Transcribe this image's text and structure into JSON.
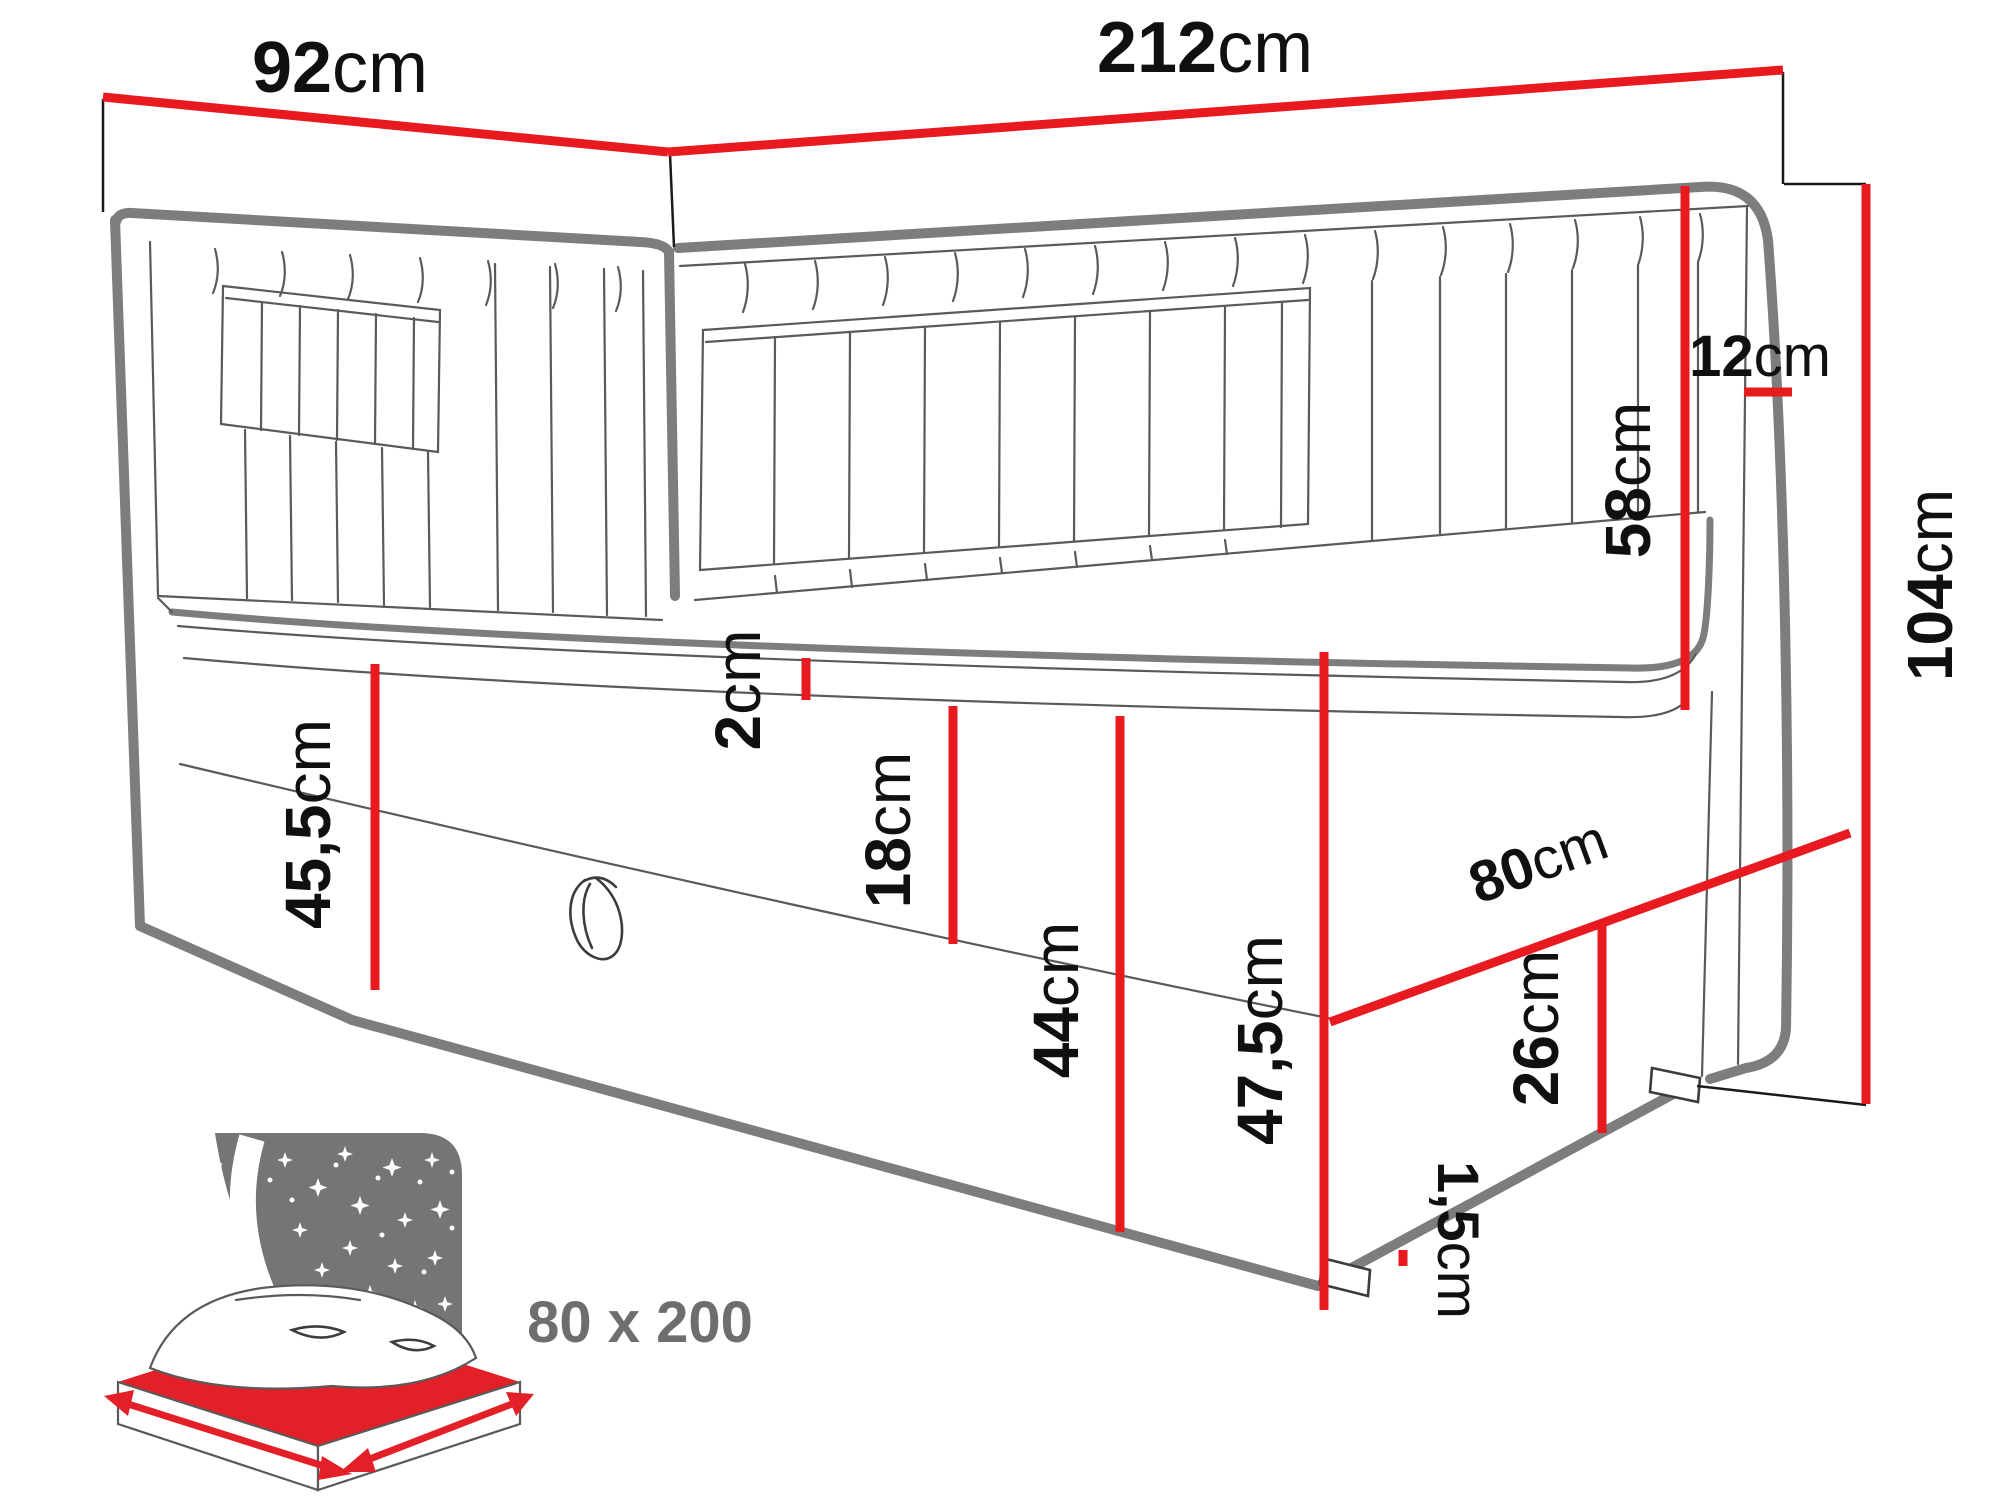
{
  "diagram_title": "Corner daybed dimension drawing",
  "colors": {
    "dimension_red": "#e8191f",
    "drawing_gray": "#7d7d7d",
    "detail_gray": "#5a5a5a",
    "text_black": "#101010",
    "icon_gray": "#757575",
    "icon_red": "#e32028",
    "badge_text_gray": "#6e6e6e"
  },
  "dimensions": {
    "side_width": {
      "num": "92",
      "unit": "cm"
    },
    "back_width": {
      "num": "212",
      "unit": "cm"
    },
    "headboard_thickness": {
      "num": "12",
      "unit": "cm"
    },
    "total_height": {
      "num": "104",
      "unit": "cm"
    },
    "headboard_height": {
      "num": "58",
      "unit": "cm"
    },
    "topper_height": {
      "num": "2",
      "unit": "cm"
    },
    "mattress_height": {
      "num": "18",
      "unit": "cm"
    },
    "base_height": {
      "num": "44",
      "unit": "cm"
    },
    "left_side_height": {
      "num": "45,5",
      "unit": "cm"
    },
    "right_side_height": {
      "num": "47,5",
      "unit": "cm"
    },
    "foot_width": {
      "num": "80",
      "unit": "cm"
    },
    "foot_panel_height": {
      "num": "26",
      "unit": "cm"
    },
    "leg_height": {
      "num": "1,5",
      "unit": "cm"
    }
  },
  "badge": {
    "sleeping_area": "80 x 200"
  },
  "icons": [
    "starry-headboard-icon",
    "crescent-fold-icon",
    "mattress-size-icon",
    "width-arrow-icon",
    "depth-arrow-icon"
  ]
}
